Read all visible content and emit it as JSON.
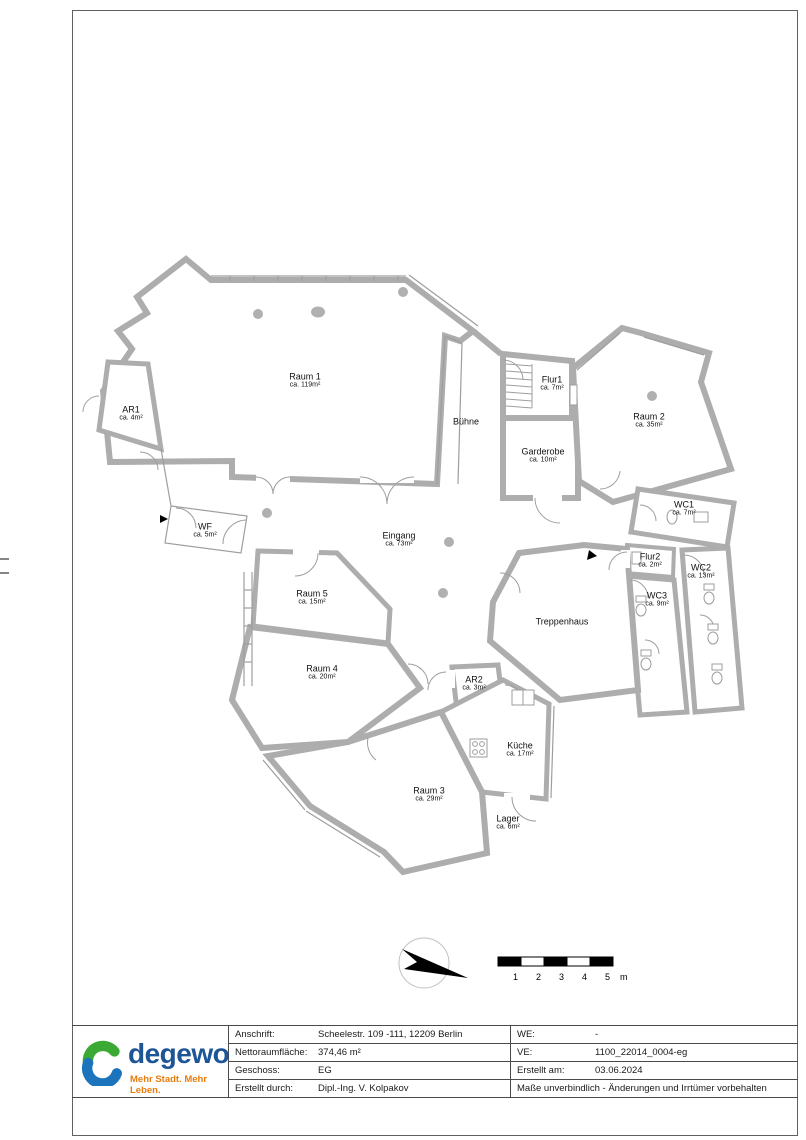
{
  "floorplan": {
    "rooms": [
      {
        "name": "Raum 1",
        "area": "ca. 119m²"
      },
      {
        "name": "AR1",
        "area": "ca. 4m²"
      },
      {
        "name": "Bühne",
        "area": ""
      },
      {
        "name": "Flur1",
        "area": "ca. 7m²"
      },
      {
        "name": "Garderobe",
        "area": "ca. 10m²"
      },
      {
        "name": "Raum 2",
        "area": "ca. 35m²"
      },
      {
        "name": "WC1",
        "area": "ca. 7m²"
      },
      {
        "name": "WF",
        "area": "ca. 5m²"
      },
      {
        "name": "Eingang",
        "area": "ca. 73m²"
      },
      {
        "name": "Flur2",
        "area": "ca. 2m²"
      },
      {
        "name": "WC2",
        "area": "ca. 13m²"
      },
      {
        "name": "Raum 5",
        "area": "ca. 15m²"
      },
      {
        "name": "WC3",
        "area": "ca. 9m²"
      },
      {
        "name": "Treppenhaus",
        "area": ""
      },
      {
        "name": "Raum 4",
        "area": "ca. 20m²"
      },
      {
        "name": "AR2",
        "area": "ca. 3m²"
      },
      {
        "name": "Küche",
        "area": "ca. 17m²"
      },
      {
        "name": "Raum 3",
        "area": "ca. 29m²"
      },
      {
        "name": "Lager",
        "area": "ca. 6m²"
      }
    ],
    "scale_bar_labels": [
      "1",
      "2",
      "3",
      "4",
      "5",
      "m"
    ]
  },
  "title_block": {
    "logo": {
      "brand": "degewo",
      "tagline": "Mehr Stadt. Mehr Leben."
    },
    "left_rows": [
      {
        "label": "Anschrift:",
        "value": "Scheelestr. 109 -111, 12209 Berlin"
      },
      {
        "label": "Nettoraumfläche:",
        "value": "374,46 m²"
      },
      {
        "label": "Geschoss:",
        "value": "EG"
      },
      {
        "label": "Erstellt durch:",
        "value": "Dipl.-Ing. V. Kolpakov"
      }
    ],
    "right_rows": [
      {
        "label": "WE:",
        "value": "-"
      },
      {
        "label": "VE:",
        "value": "1100_22014_0004-eg"
      },
      {
        "label": "Erstellt am:",
        "value": "03.06.2024"
      }
    ],
    "notice": "Maße unverbindlich - Änderungen und Irrtümer vorbehalten"
  },
  "colors": {
    "wall_gray": "#adadad",
    "brand_blue": "#1d5596",
    "ring_green": "#3aaa35",
    "ring_blue": "#1c75bc",
    "tagline_orange": "#e87c0f"
  }
}
